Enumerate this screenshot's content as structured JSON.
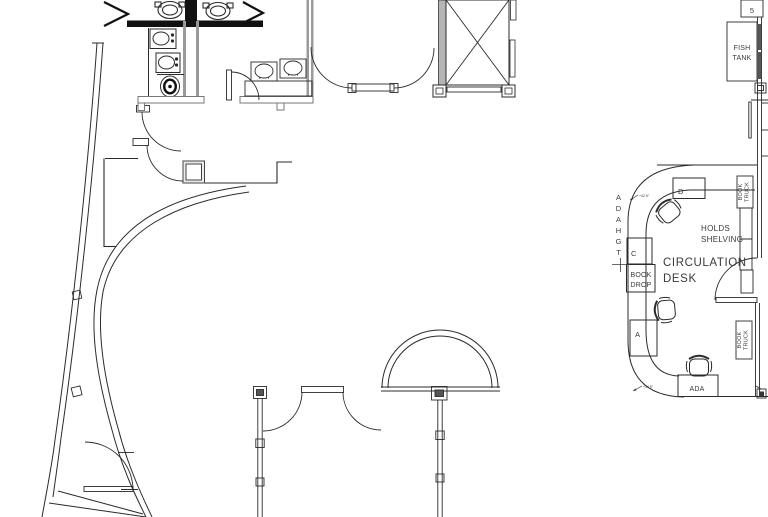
{
  "colors": {
    "background": "#ffffff",
    "line": "#2b2b2b",
    "wall_dark": "#111111",
    "wall_gray": "#9a9a9a",
    "text": "#3a3a3a"
  },
  "plan": {
    "fish_tank": {
      "line1": "FISH",
      "line2": "TANK"
    },
    "shelf_bay_number": "5",
    "holds_shelving": {
      "line1": "HOLDS",
      "line2": "SHELVING"
    },
    "circulation_desk": {
      "line1": "CIRCULATION",
      "line2": "DESK"
    },
    "book_drop": {
      "line1": "BOOK",
      "line2": "DROP"
    },
    "book_truck": {
      "line1": "BOOK",
      "line2": "TRUCK"
    },
    "counter_sections": {
      "d": "D",
      "c": "C",
      "a": "A",
      "ada": "ADA"
    },
    "ada_hgt_letters": [
      "A",
      "D",
      "A",
      "H",
      "G",
      "T"
    ],
    "dimensions": {
      "upper": "+42.5\"",
      "lower": "+34.5\""
    }
  }
}
